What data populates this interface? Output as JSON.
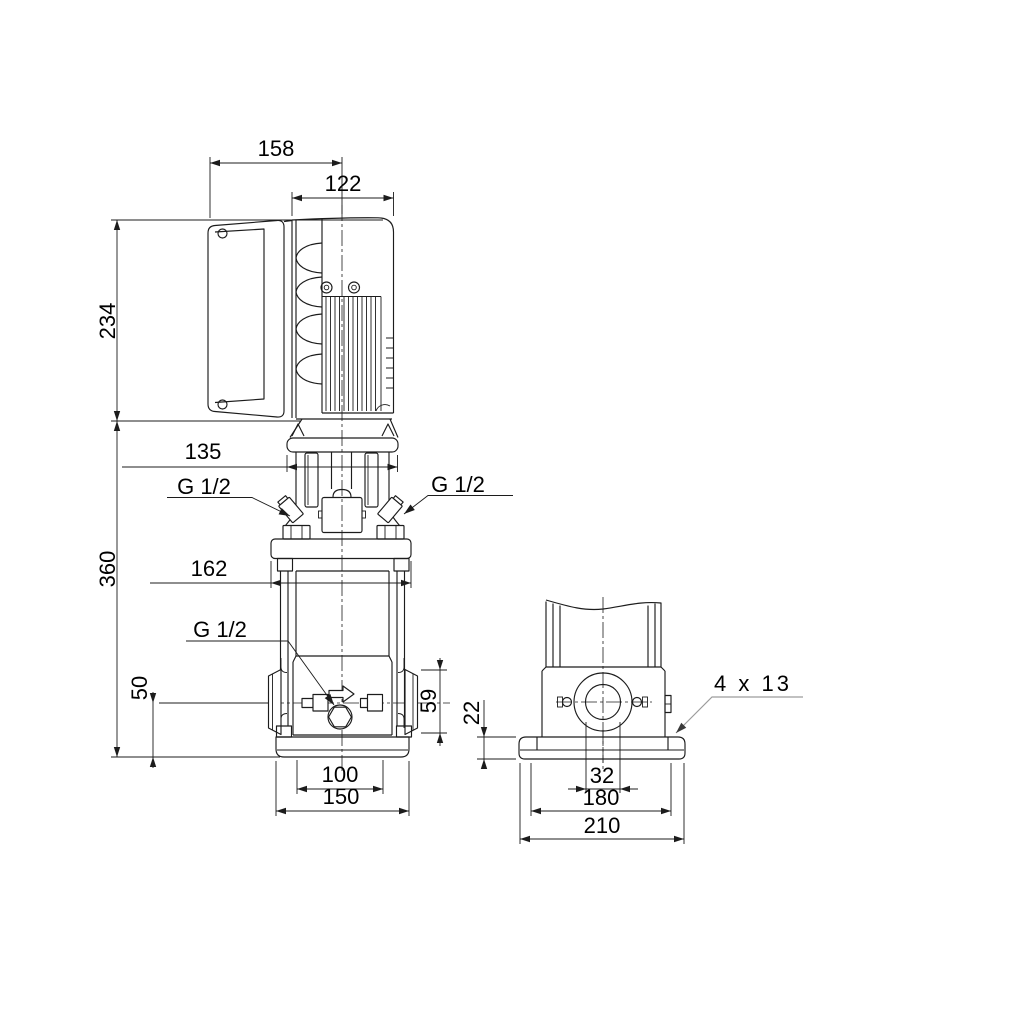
{
  "page": {
    "background": "#ffffff",
    "line_color": "#1c1c1c",
    "leader_color": "#9c9c9c"
  },
  "drawing": {
    "kind": "pump-dimensional-drawing",
    "views": [
      "front-view",
      "side-view"
    ],
    "dims": {
      "total_width": "158",
      "motor_diameter": "122",
      "motor_height": "234",
      "motor_flange_width": "135",
      "pump_height": "360",
      "head_flange_width": "162",
      "gauge_port_left": "G 1/2",
      "gauge_port_right": "G 1/2",
      "drain_port": "G 1/2",
      "port_height": "50",
      "port_flange_height": "59",
      "base_bolt_span": "100",
      "base_width": "150",
      "baseplate_height": "22",
      "port_bore": "32",
      "baseplate_bolt_span": "180",
      "baseplate_width": "210",
      "mounting_holes": "4 x 13"
    }
  }
}
